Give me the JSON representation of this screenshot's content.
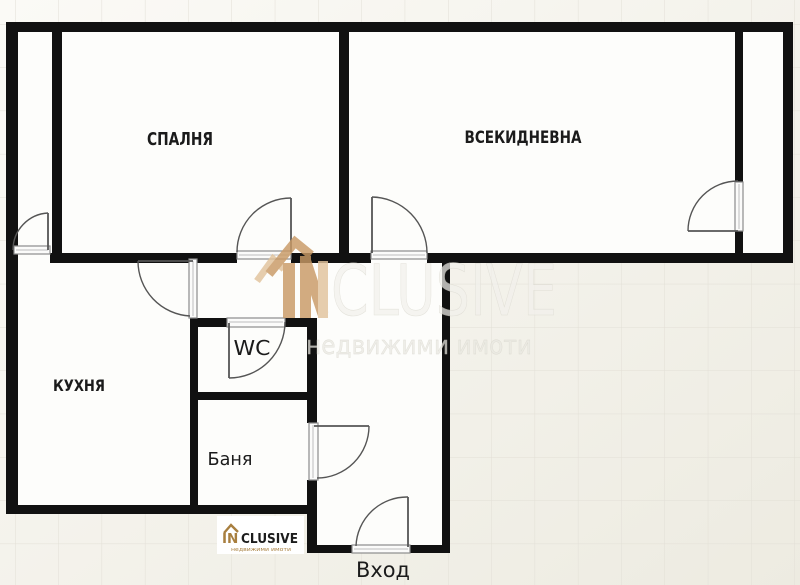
{
  "floor_plan": {
    "rooms": {
      "bedroom": {
        "label": "СПАЛНЯ"
      },
      "living_room": {
        "label": "ВСЕКИДНЕВНА"
      },
      "kitchen": {
        "label": "КУХНЯ"
      },
      "wc": {
        "label": "WC"
      },
      "bathroom": {
        "label": "Баня"
      },
      "entrance": {
        "label": "Вход"
      }
    },
    "door_count": 8
  },
  "watermark": {
    "brand_prefix": "IN",
    "brand_rest": "CLUSIVE",
    "subtitle": "недвижими имоти"
  },
  "footer_logo": {
    "brand_prefix": "IN",
    "brand_rest": "CLUSIVE",
    "subtitle": "недвижими имоти"
  },
  "colors": {
    "wall": "#111111",
    "floor": "#fdfdfb",
    "background_light": "#fbfaf6",
    "background_beige": "#edebe1",
    "grid_line": "#e2dfd6",
    "brand_tan": "#c99a66",
    "brand_tan_light": "#e2c39c",
    "brand_bronze": "#a87f3f",
    "watermark_text": "#f2f1ec",
    "label_text": "#1b1b1b",
    "door_line": "#555555"
  }
}
